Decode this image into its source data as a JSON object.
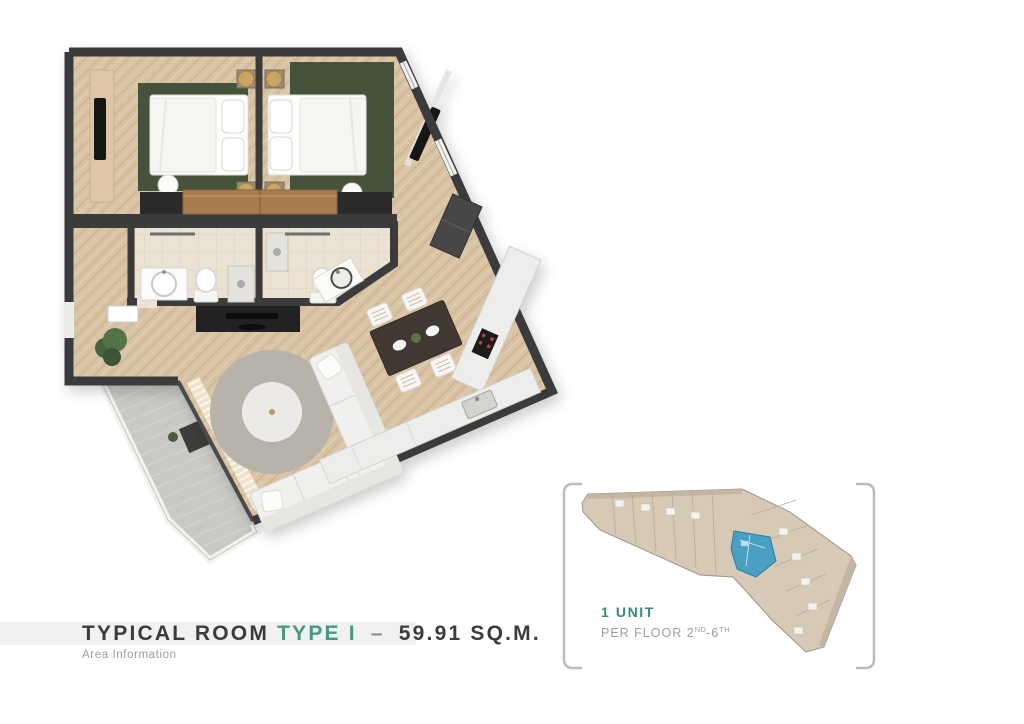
{
  "title": {
    "prefix": "TYPICAL ROOM",
    "type": "TYPE I",
    "separator": "–",
    "area": "59.91 SQ.M.",
    "subtitle": "Area Information"
  },
  "unit_info": {
    "count_label": "1 UNIT",
    "per_floor_label": "PER FLOOR",
    "floor_start": "2",
    "floor_start_sup": "ND",
    "floor_range_sep": "-",
    "floor_end": "6",
    "floor_end_sup": "TH"
  },
  "colors": {
    "accent_teal": "#449a83",
    "unit_count_teal": "#2f8e76",
    "title_text": "#3b3b3b",
    "muted_text": "#9b9b9b",
    "per_floor_text": "#99a0a3",
    "title_band_bg": "#f1f1f1",
    "bracket_gray": "#bdbdbd",
    "wall_dark": "#3a3a3a",
    "wood_floor": "#d9c3a5",
    "bathroom_tile": "#ebe2d3",
    "balcony_concrete": "#c9c8c4",
    "rug_green": "#45523b",
    "highlighted_unit_blue": "#4aa0c0",
    "floor_plate_tan": "#d6cab7"
  }
}
